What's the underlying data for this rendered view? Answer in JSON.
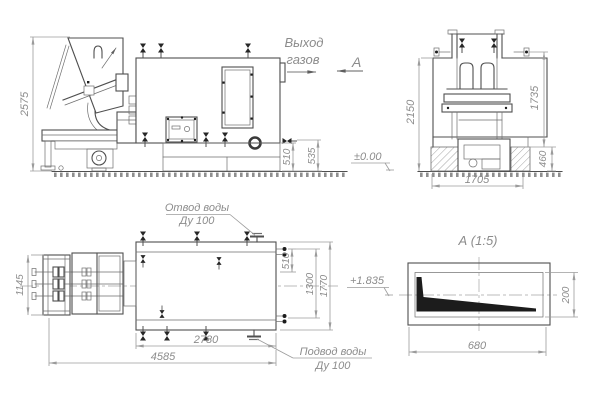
{
  "drawing": {
    "type": "engineering-drawing",
    "language": "ru",
    "colors": {
      "background": "#ffffff",
      "main_line": "#4f4f4f",
      "dim_line": "#9b9b9b",
      "dim_text": "#8c8c8c",
      "solid_fill": "#1c1c1c"
    },
    "side_view": {
      "gas_outlet_label": {
        "line1": "Выход",
        "line2": "газов"
      },
      "view_direction_label": "А",
      "elevation_mark": "±0.00",
      "dims": {
        "overall_height": "2575",
        "base_height_1": "510",
        "base_height_2": "535"
      }
    },
    "front_view": {
      "dims": {
        "overall_height": "2150",
        "body_height": "1735",
        "foundation_height": "460",
        "overall_width": "1705"
      }
    },
    "plan_view": {
      "water_outlet_label": {
        "line1": "Отвод воды",
        "line2": "Ду 100"
      },
      "water_inlet_label": {
        "line1": "Подвод воды",
        "line2": "Ду 100"
      },
      "elevation_mark": "+1.835",
      "dims": {
        "feeder_width": "1145",
        "nozzle_offset": "510",
        "nozzle_span": "1300",
        "body_width": "1770",
        "body_length": "2780",
        "overall_length": "4585"
      }
    },
    "detail_view": {
      "title": "А  (1:5)",
      "dims": {
        "length": "680",
        "height": "200"
      }
    }
  }
}
